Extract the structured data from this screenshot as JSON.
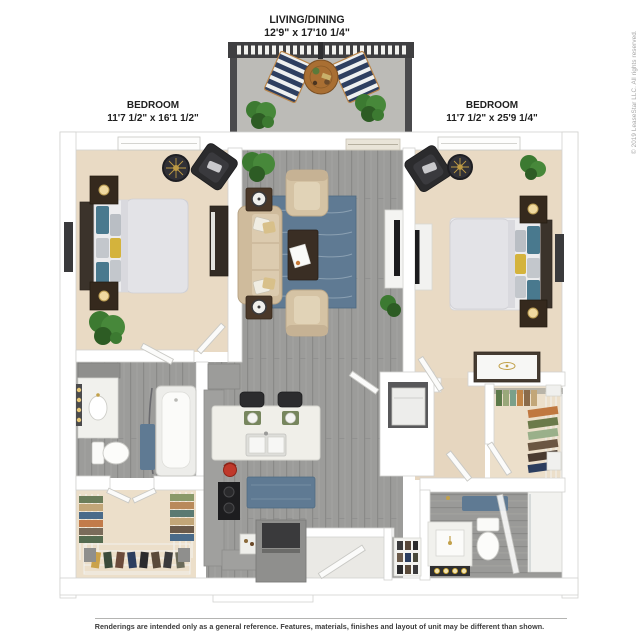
{
  "plan": {
    "living_dining": {
      "label": "LIVING/DINING",
      "dims": "12'9\" x 17'10 1/4\""
    },
    "bedroom_left": {
      "label": "BEDROOM",
      "dims": "11'7 1/2\" x 16'1 1/2\""
    },
    "bedroom_right": {
      "label": "BEDROOM",
      "dims": "11'7 1/2\" x 25'9 1/4\""
    }
  },
  "copyright": "© 2019 LeaseStar LLC. All rights reserved.",
  "footer": {
    "disclaimer": "Renderings are intended only as a general reference. Features, materials, finishes and layout of unit may be different than shown."
  },
  "colors": {
    "background": "#ffffff",
    "wall": "#ffffff",
    "wood_floor": "#9c9c9a",
    "carpet": "#e9dac4",
    "balcony_concrete": "#bcbbb7",
    "rug_blue": "#5f7a93",
    "sofa_beige": "#d5c3a4",
    "dark_furniture": "#35291d",
    "black_furniture": "#2b2b2d",
    "accent_teal": "#49798e",
    "accent_yellow": "#d4b33c",
    "plant_green": "#3c7a31",
    "deckchair_navy": "#2e3f60",
    "table_wood": "#a96f33",
    "label_text": "#1f1f1f",
    "disclaimer_text": "#3b3b3b",
    "copyright_text": "#a6a6a6"
  }
}
